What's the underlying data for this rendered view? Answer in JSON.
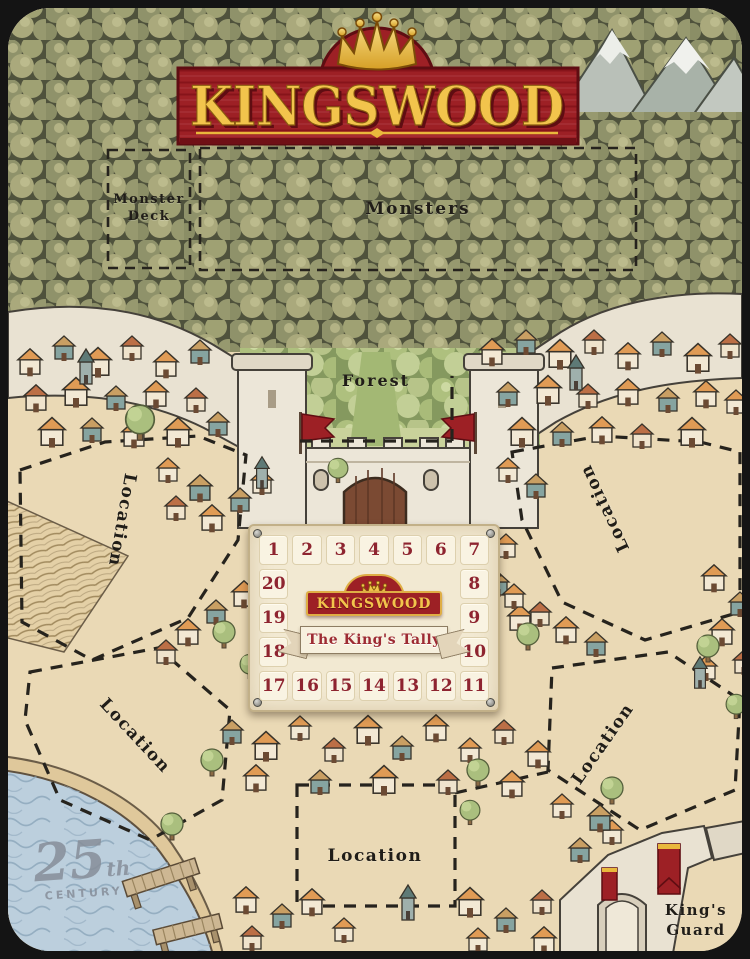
{
  "title": {
    "text": "KINGSWOOD"
  },
  "zones": {
    "monster_deck": "Monster Deck",
    "monsters": "Monsters",
    "forest": "Forest",
    "kings_guard": "King's Guard",
    "locations": [
      "Location",
      "Location",
      "Location",
      "Location",
      "Location"
    ]
  },
  "tally": {
    "logo": "KINGSWOOD",
    "banner": "The King's Tally",
    "numbers": [
      "1",
      "2",
      "3",
      "4",
      "5",
      "6",
      "7",
      "8",
      "9",
      "10",
      "11",
      "12",
      "13",
      "14",
      "15",
      "16",
      "17",
      "18",
      "19",
      "20"
    ]
  },
  "watermark": {
    "big": "25",
    "suffix": "th",
    "caption": "CENTURY"
  },
  "colors": {
    "banner_red": "#9d2025",
    "banner_dark_red": "#5f0d12",
    "gold": "#f2c44c",
    "parchment": "#ead9b5",
    "forest_dark": "#7e815d",
    "forest_light": "#9db26f",
    "stone_wall": "#ece6d8",
    "water": "#bccfdd",
    "tally_card": "#f2e9d2",
    "tally_number": "#8e2430",
    "dashed_line": "#26231d",
    "label_text": "#201d18"
  }
}
